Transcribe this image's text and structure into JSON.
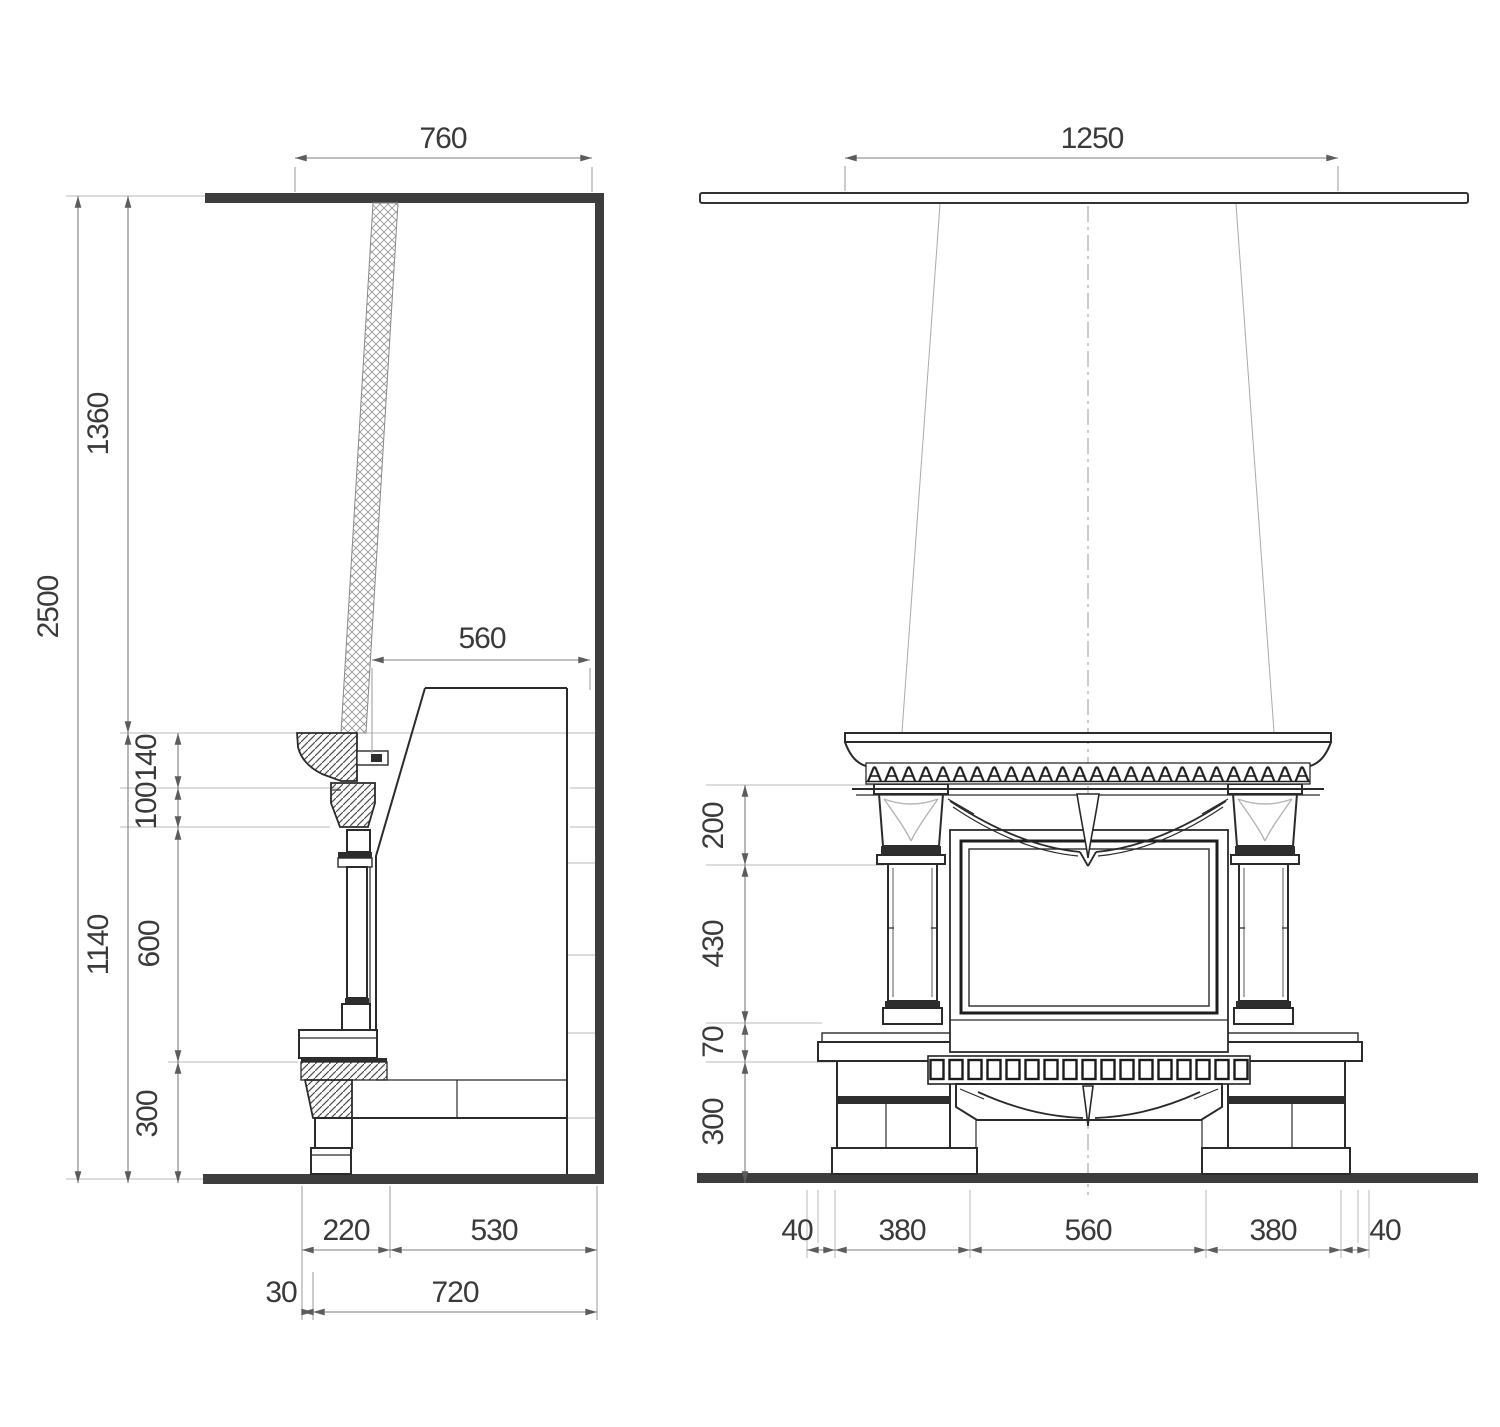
{
  "drawing": {
    "kind": "fireplace technical drawing — side section and front elevation",
    "units": "mm",
    "side_view": {
      "top_opening_width": "760",
      "room_height": "2500",
      "flue_height": "1360",
      "fireplace_height": "1140",
      "mantel_height": "140",
      "corbel_height": "100",
      "opening_height": "600",
      "plinth_height": "300",
      "smoke_chamber_depth": "560",
      "hearth_depth": "220",
      "body_depth": "530",
      "hearth_overhang": "30",
      "total_depth": "720"
    },
    "front_view": {
      "flue_span": "1250",
      "capital_height": "200",
      "column_height": "430",
      "shelf_height": "70",
      "plinth_height": "300",
      "left_margin": "40",
      "left_pier_width": "380",
      "opening_width": "560",
      "right_pier_width": "380",
      "right_margin": "40"
    }
  }
}
